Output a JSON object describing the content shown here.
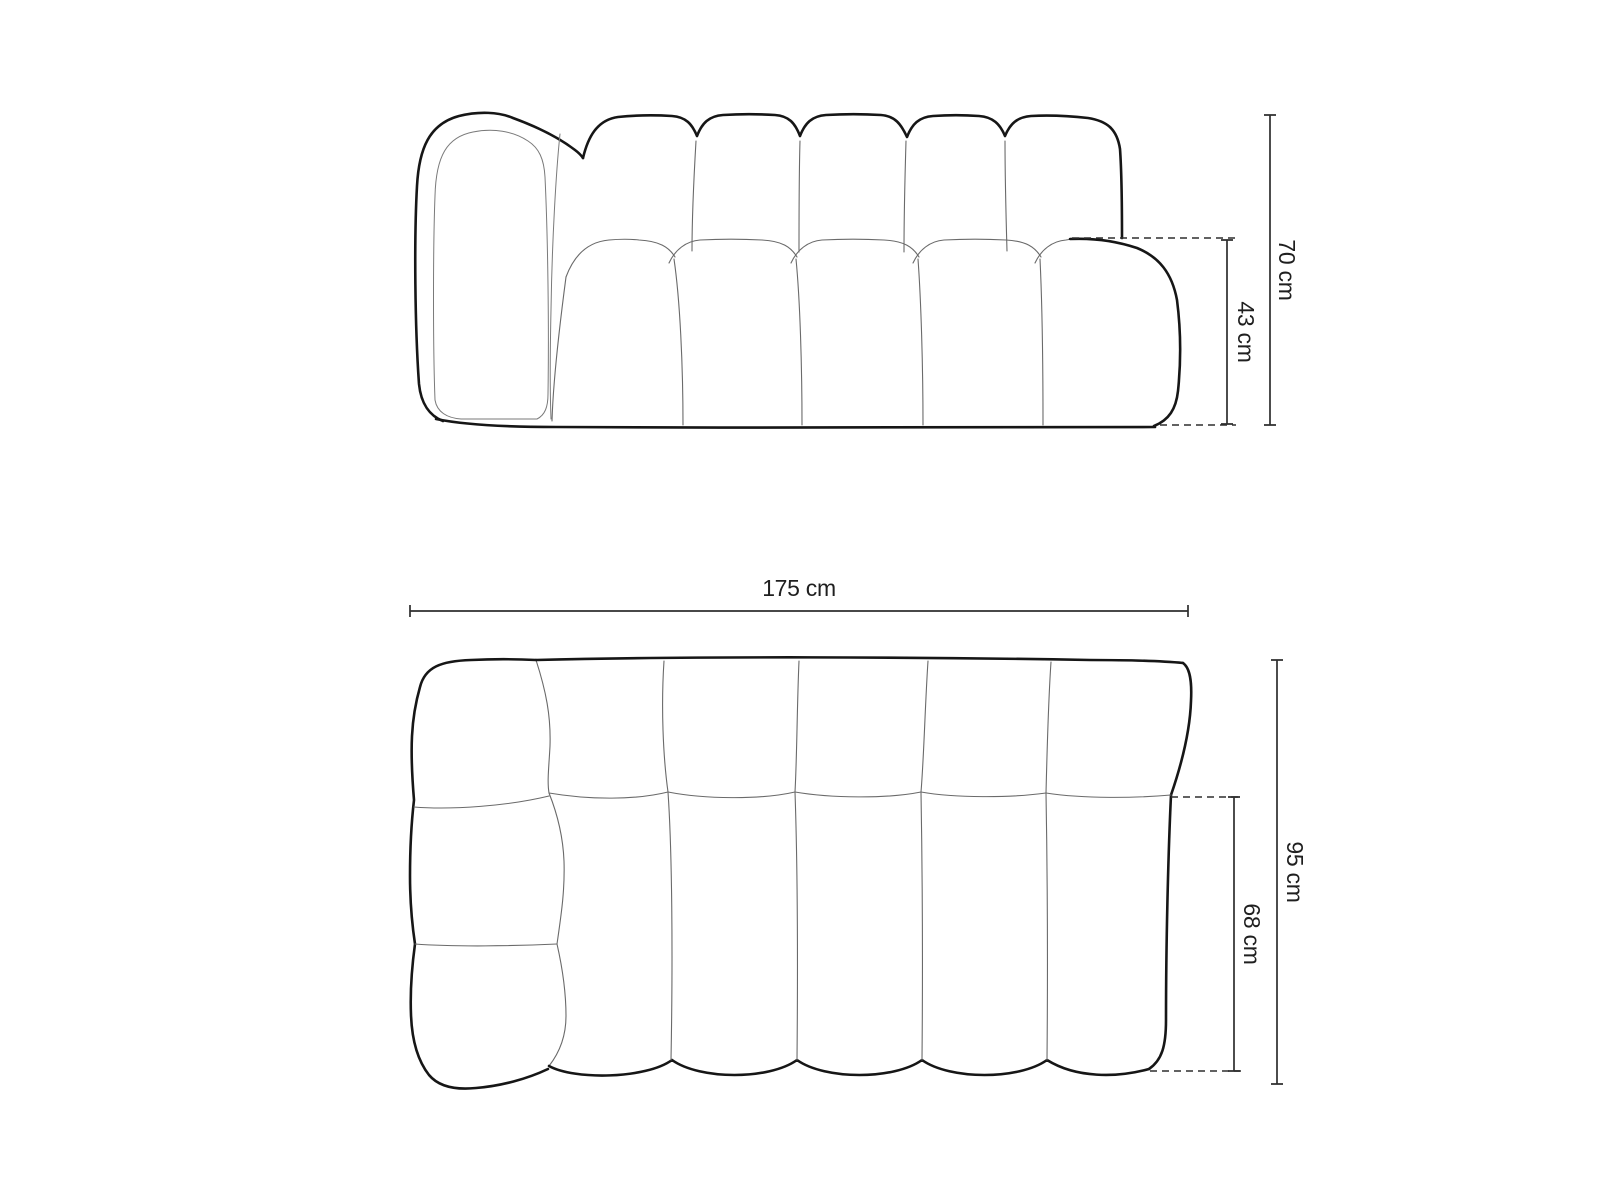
{
  "page": {
    "background": "#ffffff"
  },
  "front_view": {
    "dimensions": {
      "total_height": {
        "label": "70 cm"
      },
      "seat_height": {
        "label": "43 cm"
      }
    }
  },
  "top_view": {
    "dimensions": {
      "total_width": {
        "label": "175 cm"
      },
      "total_depth": {
        "label": "95 cm"
      },
      "seat_depth": {
        "label": "68 cm"
      }
    }
  },
  "colors": {
    "outline": "#161616",
    "seam": "#6a6a6a",
    "dimension": "#2e2e2e",
    "background": "#ffffff"
  }
}
